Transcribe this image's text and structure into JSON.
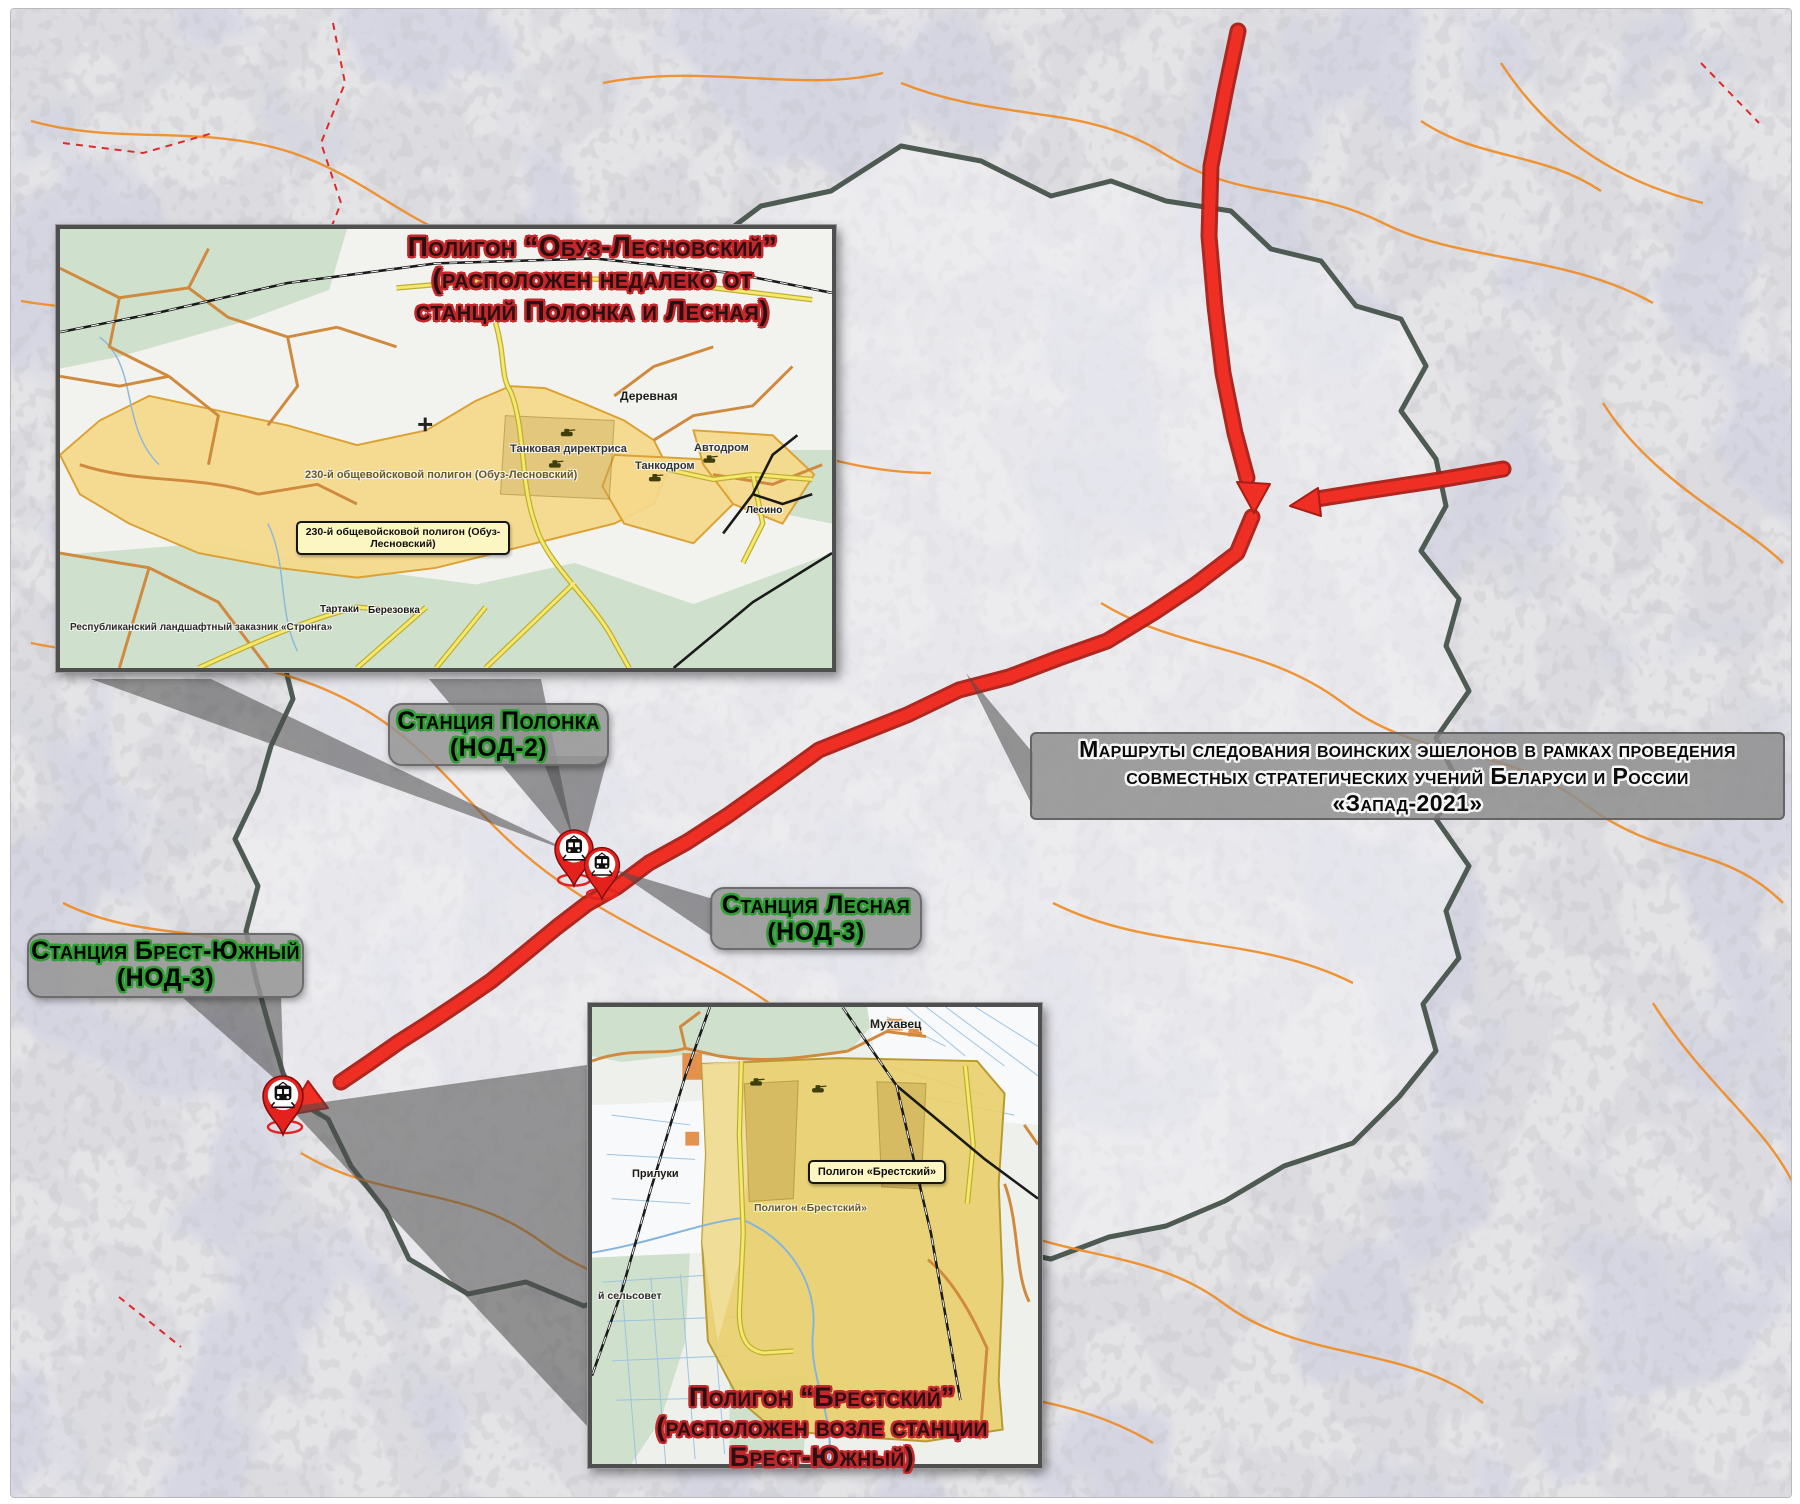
{
  "colors": {
    "route_red": "#ef2f24",
    "route_red_dark": "#a91d15",
    "pin_red": "#e5211d",
    "belarus_border": "#4e5b53",
    "training_ground_yellow": "#f5d98a",
    "forest_green": "#cfe0cc",
    "orange_road": "#ef8a1f",
    "label_box_yellow": "#fcf6c3",
    "gray_callout": "#8c8c8c",
    "title_outline_red": "#c3262b",
    "station_outline_green": "#2f9e33"
  },
  "note": {
    "line1": "Маршруты следования воинских эшелонов в рамках проведения",
    "line2": "совместных стратегических учений Беларуси и России",
    "line3": "«Запад-2021»"
  },
  "stations": {
    "polonka": {
      "name": "Станция Полонка",
      "code": "(НОД-2)"
    },
    "lesnaya": {
      "name": "Станция Лесная",
      "code": "(НОД-3)"
    },
    "brest": {
      "name": "Станция Брест-Южный",
      "code": "(НОД-3)"
    }
  },
  "insets": {
    "obuz": {
      "title_line1": "Полигон “Обуз-Лесновский”",
      "title_line2": "(расположен недалеко от",
      "title_line3": "станций Полонка и Лесная)",
      "area_label": "230-й общевойсковой полигон (Обуз-Лесновский)",
      "label_box": "230-й общевойсковой полигон (Обуз-Лесновский)",
      "places": {
        "derevnaya": "Деревная",
        "tank_directrix": "Танковая директриса",
        "tankodrom": "Танкодром",
        "avtodrom": "Автодром",
        "lesino": "Лесино",
        "tartaki": "Тартаки",
        "berezovka": "Березовка",
        "stronga": "Республиканский ландшафтный заказник «Стронга»"
      }
    },
    "brest": {
      "title_line1": "Полигон “Брестский”",
      "title_line2": "(расположен возле станции",
      "title_line3": "Брест-Южный)",
      "area_label": "Полигон «Брестский»",
      "label_box": "Полигон «Брестский»",
      "places": {
        "mukhavets": "Мухавец",
        "priluki": "Прилуки",
        "selsovet": "й сельсовет"
      }
    }
  }
}
